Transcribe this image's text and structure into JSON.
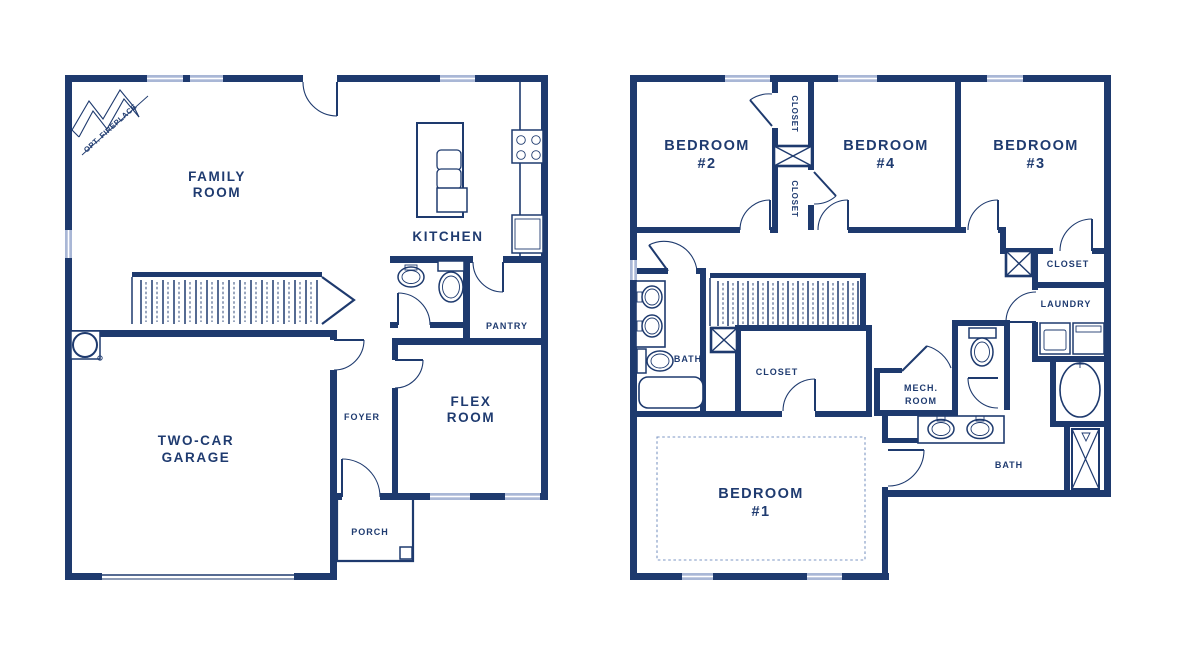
{
  "colors": {
    "wall_navy": "#1e3a6e",
    "window_light_blue": "#a9b7d6",
    "dashed_ceiling": "#7e97c4",
    "background": "#ffffff"
  },
  "floor1": {
    "labels": {
      "opt_fireplace": "OPT. FIREPLACE",
      "family_room": [
        "FAMILY",
        "ROOM"
      ],
      "kitchen": "KITCHEN",
      "pantry": "PANTRY",
      "flex_room": [
        "FLEX",
        "ROOM"
      ],
      "foyer": "FOYER",
      "garage": [
        "TWO-CAR",
        "GARAGE"
      ],
      "porch": "PORCH"
    }
  },
  "floor2": {
    "labels": {
      "bedroom2": [
        "BEDROOM",
        "#2"
      ],
      "bedroom4": [
        "BEDROOM",
        "#4"
      ],
      "bedroom3": [
        "BEDROOM",
        "#3"
      ],
      "closet_upper": "CLOSET",
      "closet_lower": "CLOSET",
      "closet_br3": "CLOSET",
      "laundry": "LAUNDRY",
      "bath_hall": "BATH",
      "closet_master": "CLOSET",
      "mech_room": [
        "MECH.",
        "ROOM"
      ],
      "bath_master": "BATH",
      "bedroom1": [
        "BEDROOM",
        "#1"
      ]
    }
  }
}
